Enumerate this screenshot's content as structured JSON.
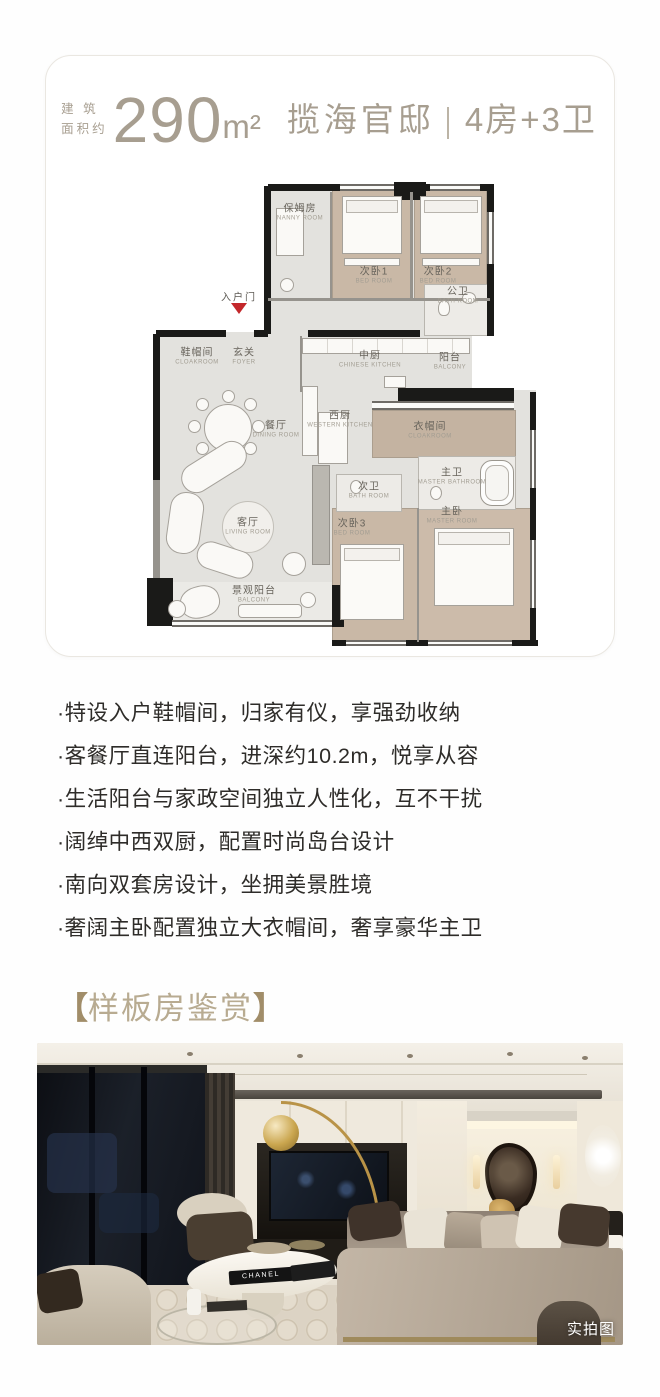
{
  "page": {
    "background": "#fefefe",
    "accent_color": "#a79e90",
    "bracket_color": "#a18d69",
    "entry_marker_color": "#c3272b"
  },
  "card": {
    "header": {
      "area_prefix_line1": "建 筑",
      "area_prefix_line2": "面积约",
      "area_value": "290",
      "area_unit": "m²",
      "estate_name": "揽海官邸",
      "layout": "4房+3卫"
    },
    "floorplan": {
      "entrance_label": "入户门",
      "rooms": [
        {
          "zh": "保姆房",
          "en": "NANNY ROOM"
        },
        {
          "zh": "次卧1",
          "en": "BED ROOM"
        },
        {
          "zh": "次卧2",
          "en": "BED ROOM"
        },
        {
          "zh": "公卫",
          "en": "BATH ROOM"
        },
        {
          "zh": "鞋帽间",
          "en": "CLOAKROOM"
        },
        {
          "zh": "玄关",
          "en": "FOYER"
        },
        {
          "zh": "中厨",
          "en": "CHINESE KITCHEN"
        },
        {
          "zh": "阳台",
          "en": "BALCONY"
        },
        {
          "zh": "西厨",
          "en": "WESTERN KITCHEN"
        },
        {
          "zh": "餐厅",
          "en": "DINING ROOM"
        },
        {
          "zh": "衣帽间",
          "en": "CLOAKROOM"
        },
        {
          "zh": "主卫",
          "en": "MASTER BATHROOM"
        },
        {
          "zh": "次卫",
          "en": "BATH ROOM"
        },
        {
          "zh": "客厅",
          "en": "LIVING ROOM"
        },
        {
          "zh": "次卧3",
          "en": "BED ROOM"
        },
        {
          "zh": "主卧",
          "en": "MASTER ROOM"
        },
        {
          "zh": "景观阳台",
          "en": "BALCONY"
        }
      ]
    }
  },
  "features": {
    "items": [
      "·特设入户鞋帽间，归家有仪，享强劲收纳",
      "·客餐厅直连阳台，进深约10.2m，悦享从容",
      "·生活阳台与家政空间独立人性化，互不干扰",
      "·阔绰中西双厨，配置时尚岛台设计",
      "·南向双套房设计，坐拥美景胜境",
      "·奢阔主卧配置独立大衣帽间，奢享豪华主卫"
    ]
  },
  "section": {
    "bracket_open": "【",
    "title": "样板房鉴赏",
    "bracket_close": "】"
  },
  "photo": {
    "book_title": "CHANEL",
    "tag": "实拍图"
  }
}
